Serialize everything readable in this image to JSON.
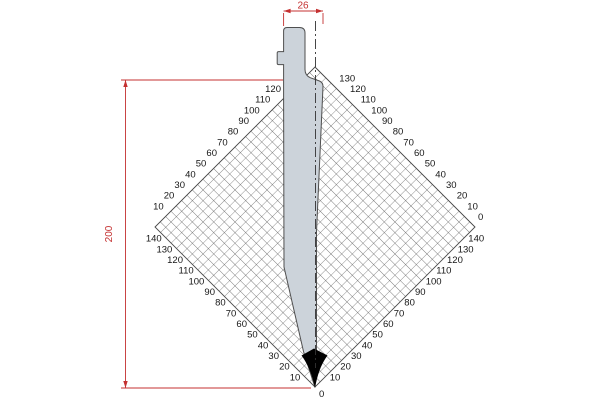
{
  "drawing": {
    "dimensions": {
      "top_width": "26",
      "left_height": "200"
    },
    "tip_label": "0",
    "rulers": {
      "step_mm": 10,
      "top_left": [
        120,
        110,
        100,
        90,
        80,
        70,
        60,
        50,
        40,
        30,
        20,
        10
      ],
      "top_right": [
        130,
        120,
        110,
        100,
        90,
        80,
        70,
        60,
        50,
        40,
        30,
        20,
        10,
        0
      ],
      "bottom_left": [
        140,
        130,
        120,
        110,
        100,
        90,
        80,
        70,
        60,
        50,
        40,
        30,
        20,
        10
      ],
      "bottom_right": [
        140,
        130,
        120,
        110,
        100,
        90,
        80,
        70,
        60,
        50,
        40,
        30,
        20,
        10
      ]
    },
    "colors": {
      "red": "#c43131",
      "tool_fill": "#ccd3da",
      "tool_stroke": "#4f4f4f",
      "grid_line": "#4a4a4a",
      "text": "#161616",
      "tip": "#000000"
    }
  }
}
